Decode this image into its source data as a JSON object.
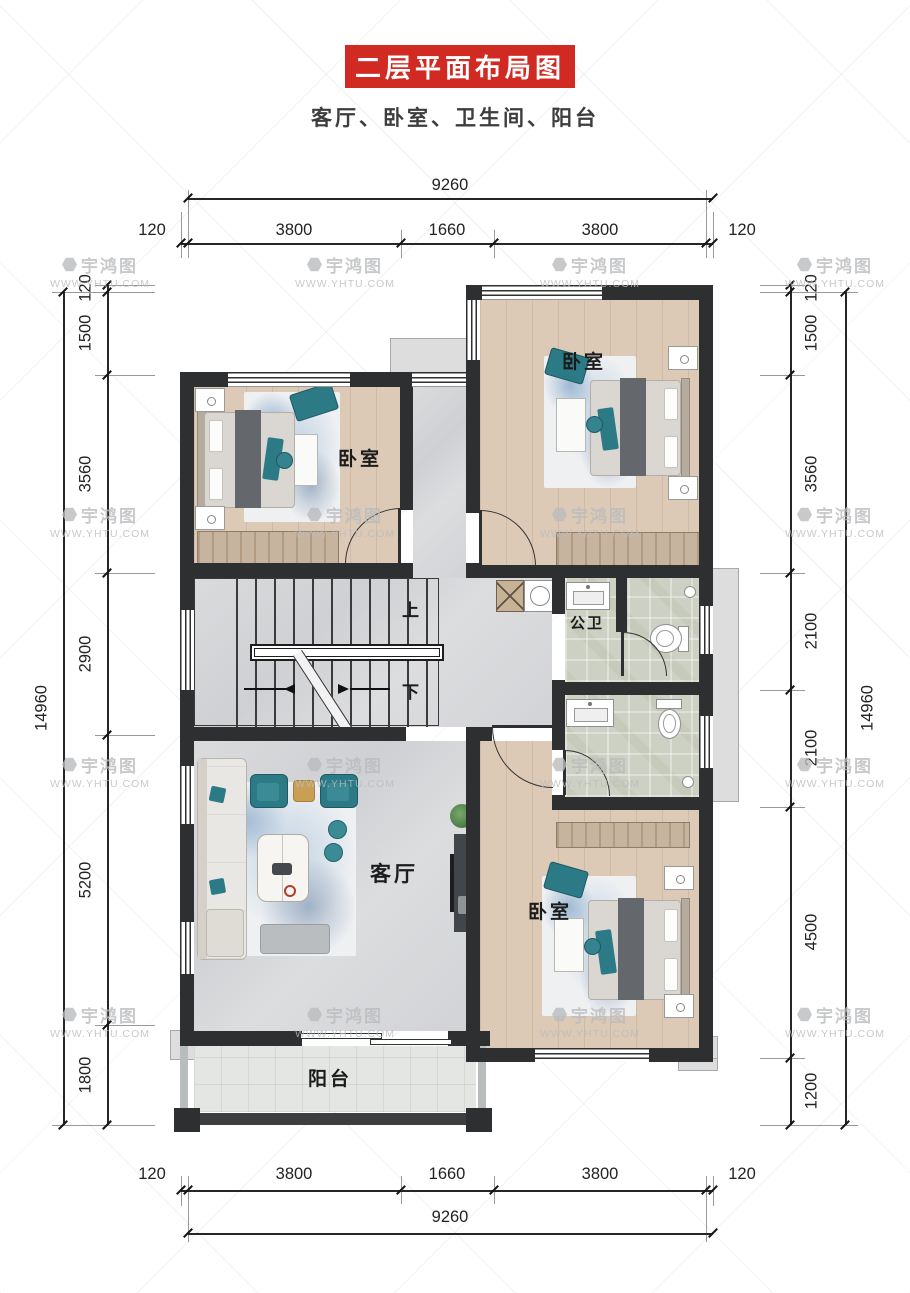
{
  "header": {
    "title": "二层平面布局图",
    "subtitle": "客厅、卧室、卫生间、阳台"
  },
  "watermark": {
    "brand": "宇鸿图",
    "url": "WWW.YHTU.COM"
  },
  "rooms": {
    "bedroom_top_left": "卧室",
    "bedroom_top_right": "卧室",
    "bedroom_bottom_right": "卧室",
    "bathroom_public": "公卫",
    "living_room": "客厅",
    "balcony": "阳台"
  },
  "stairs": {
    "up": "上",
    "down": "下"
  },
  "dimensions": {
    "top": {
      "overall": "9260",
      "segments": [
        "120",
        "3800",
        "1660",
        "3800",
        "120"
      ]
    },
    "bottom": {
      "overall": "9260",
      "segments": [
        "120",
        "3800",
        "1660",
        "3800",
        "120"
      ]
    },
    "left": {
      "overall": "14960",
      "segments": [
        "120",
        "1500",
        "3560",
        "2900",
        "5200",
        "1800"
      ]
    },
    "right": {
      "overall": "14960",
      "segments": [
        "120",
        "1500",
        "3560",
        "2100",
        "2100",
        "4500",
        "1200"
      ]
    }
  },
  "colors": {
    "banner_red": "#d02a23",
    "wall": "#2e2f31",
    "accent_teal": "#2c7a86",
    "wood_floor": "#dccab6",
    "marble_floor": "#d6d7d9",
    "tile_floor": "#ccd1c3"
  }
}
